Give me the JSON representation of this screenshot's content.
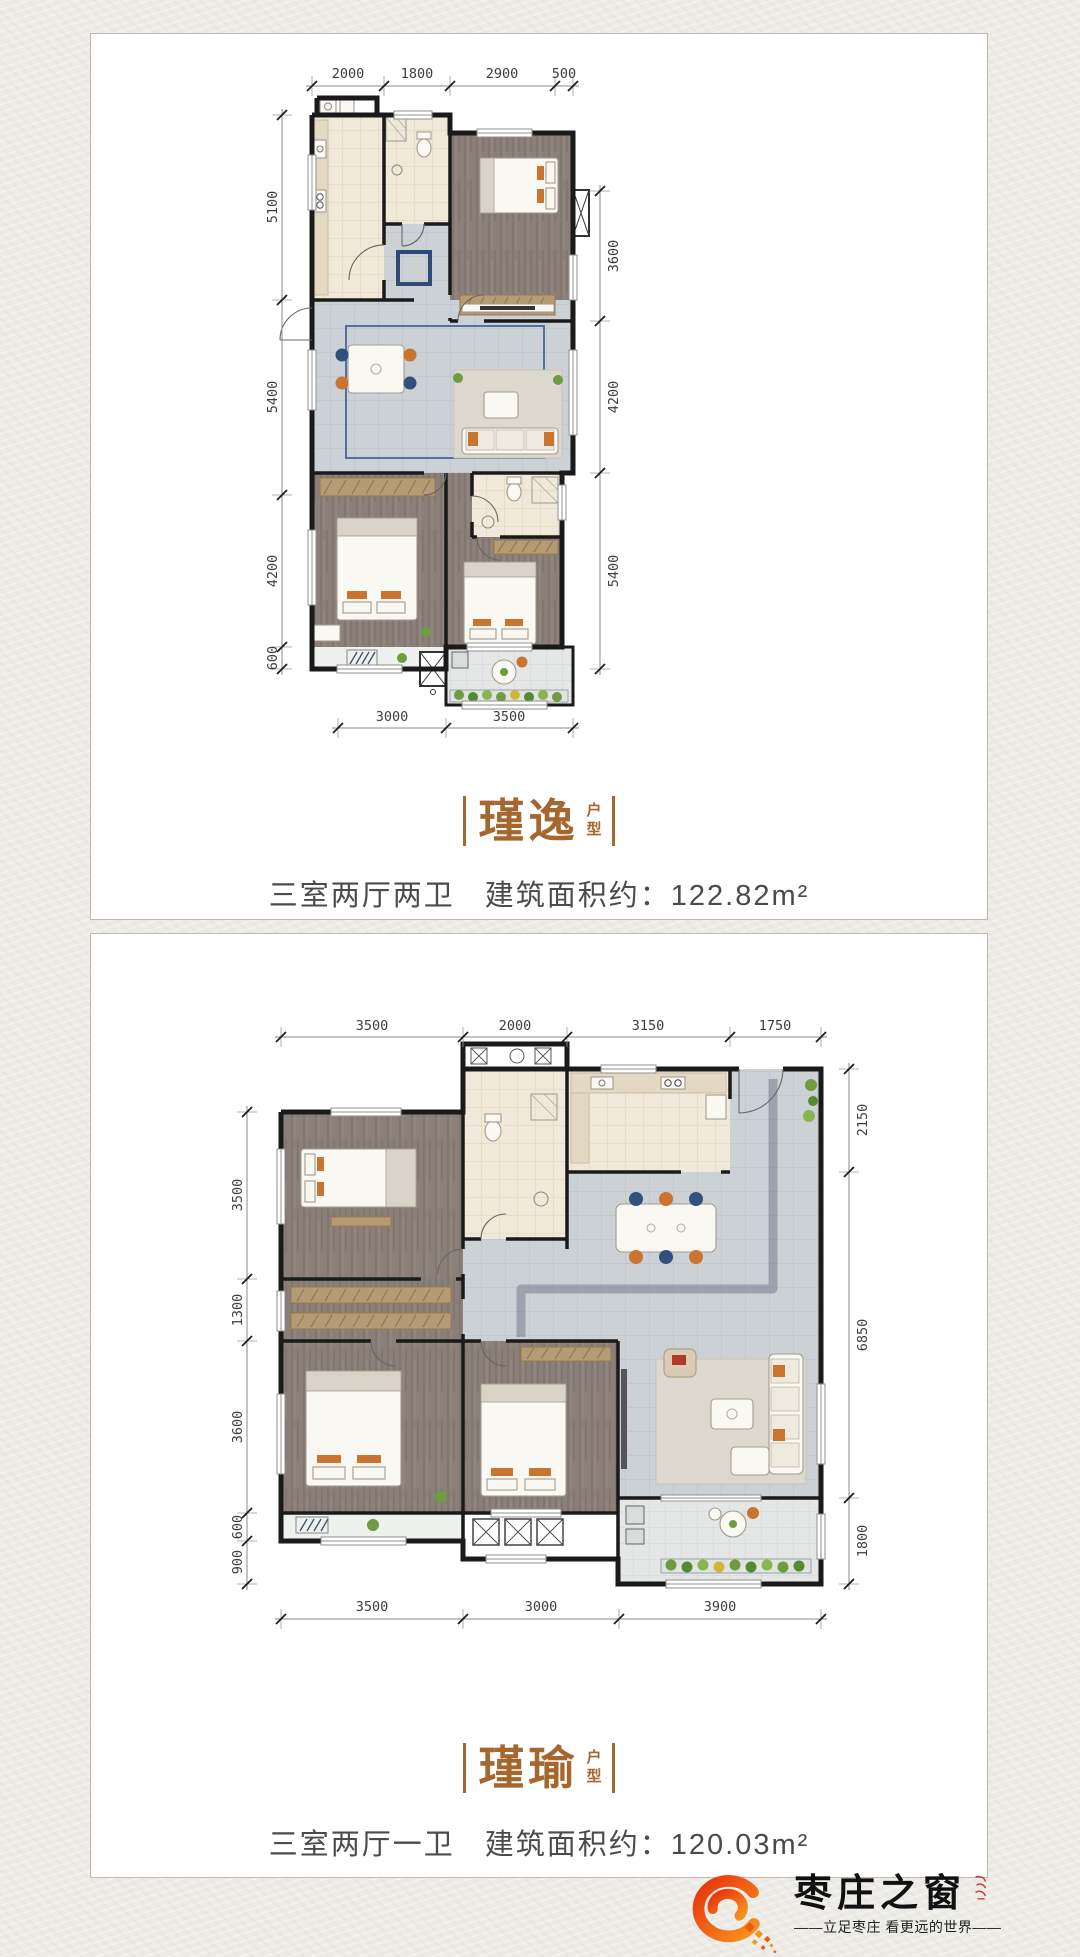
{
  "plans": {
    "p1": {
      "name": "瑾逸",
      "suffix_top": "户",
      "suffix_bottom": "型",
      "layout_label": "三室两厅两卫",
      "area_label": "建筑面积约：122.82m²",
      "dims": {
        "top": [
          "2000",
          "1800",
          "2900",
          "500"
        ],
        "left": [
          "5100",
          "5400",
          "4200",
          "600"
        ],
        "right": [
          "3600",
          "4200",
          "5400"
        ],
        "bottom": [
          "3000",
          "3500"
        ]
      }
    },
    "p2": {
      "name": "瑾瑜",
      "suffix_top": "户",
      "suffix_bottom": "型",
      "layout_label": "三室两厅一卫",
      "area_label": "建筑面积约：120.03m²",
      "dims": {
        "top": [
          "3500",
          "2000",
          "3150",
          "1750"
        ],
        "left": [
          "3500",
          "1300",
          "3600",
          "600",
          "900"
        ],
        "right": [
          "2150",
          "6850",
          "1800"
        ],
        "bottom": [
          "3500",
          "3000",
          "3900"
        ]
      }
    }
  },
  "logo": {
    "brand": "枣庄之窗",
    "tagline": "——立足枣庄 看更远的世界——"
  },
  "colors": {
    "title_accent": "#a5672e",
    "desc_text": "#4b4b4b",
    "wall": "#1a1a1a",
    "wood_floor": "#8b8079",
    "tile_floor": "#ccd1d6",
    "beige_floor": "#f0e9d9",
    "accent_navy": "#31507e",
    "accent_orange": "#c9742f",
    "plant_green": "#6f9c3e",
    "logo_red": "#e8320c",
    "logo_orange": "#f7941d",
    "seal_red": "#c5281c"
  }
}
